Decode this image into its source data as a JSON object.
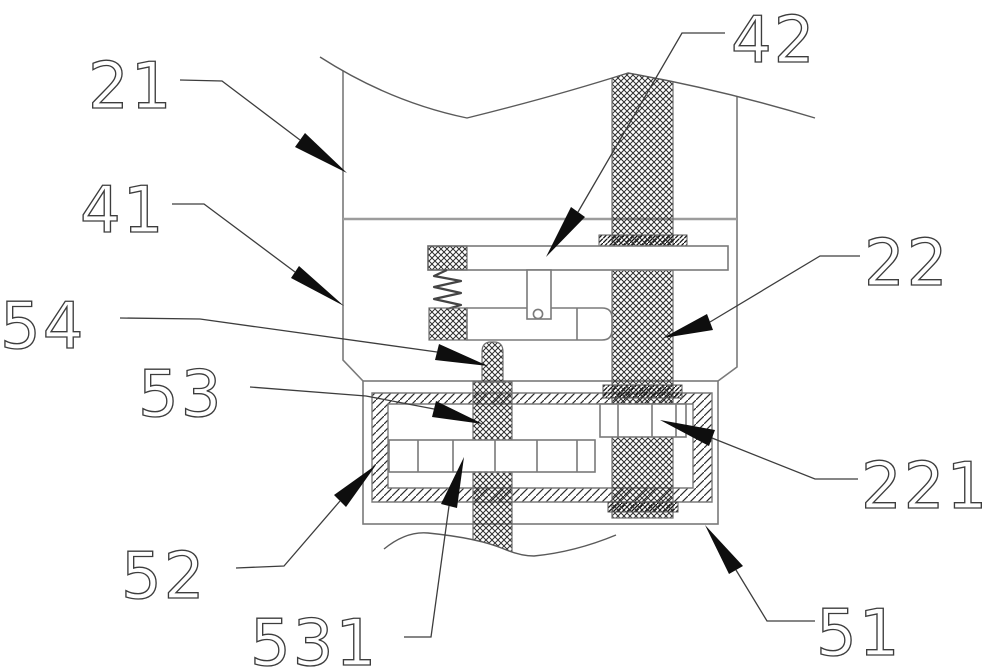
{
  "figure": {
    "kind": "patent mechanical section drawing",
    "background_color": "#ffffff",
    "line_color": "#7a7a7a",
    "leader_color": "#3d3d3d",
    "arrow_color": "#0e0e0e",
    "hatch_color": "#2e2e2e"
  },
  "labels": {
    "part21": "21",
    "part41": "41",
    "part54": "54",
    "part53": "53",
    "part52": "52",
    "part531": "531",
    "part42": "42",
    "part22": "22",
    "part221": "221",
    "part51": "51"
  }
}
